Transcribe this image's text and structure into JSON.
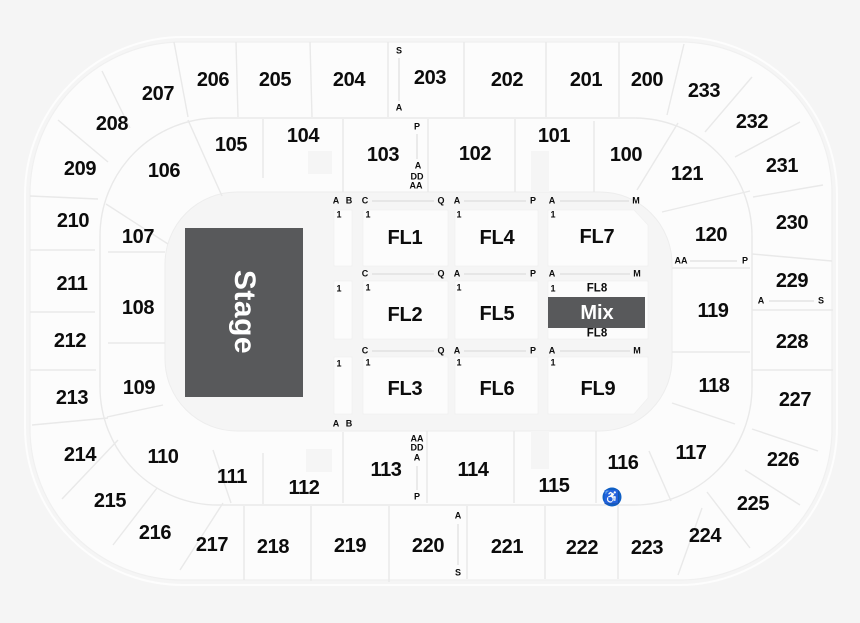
{
  "colors": {
    "background": "#f5f5f5",
    "section_fill": "#fcfcfc",
    "divider": "#e9e9e9",
    "stage_fill": "#58595b",
    "text": "#0c0c0c",
    "accessible_badge": "#0e5fc5",
    "accessible_glyph": "#ffffff"
  },
  "stage": {
    "label": "Stage",
    "x": 244,
    "y": 312
  },
  "mix": {
    "label": "Mix",
    "x": 597,
    "y": 313
  },
  "outer_ring_sections": [
    {
      "label": "200",
      "x": 647,
      "y": 80
    },
    {
      "label": "201",
      "x": 586,
      "y": 80
    },
    {
      "label": "202",
      "x": 507,
      "y": 80
    },
    {
      "label": "203",
      "x": 430,
      "y": 78
    },
    {
      "label": "204",
      "x": 349,
      "y": 80
    },
    {
      "label": "205",
      "x": 275,
      "y": 80
    },
    {
      "label": "206",
      "x": 213,
      "y": 80
    },
    {
      "label": "207",
      "x": 158,
      "y": 94
    },
    {
      "label": "208",
      "x": 112,
      "y": 124
    },
    {
      "label": "209",
      "x": 80,
      "y": 169
    },
    {
      "label": "210",
      "x": 73,
      "y": 221
    },
    {
      "label": "211",
      "x": 72,
      "y": 284
    },
    {
      "label": "212",
      "x": 70,
      "y": 341
    },
    {
      "label": "213",
      "x": 72,
      "y": 398
    },
    {
      "label": "214",
      "x": 80,
      "y": 455
    },
    {
      "label": "215",
      "x": 110,
      "y": 501
    },
    {
      "label": "216",
      "x": 155,
      "y": 533
    },
    {
      "label": "217",
      "x": 212,
      "y": 545
    },
    {
      "label": "218",
      "x": 273,
      "y": 547
    },
    {
      "label": "219",
      "x": 350,
      "y": 546
    },
    {
      "label": "220",
      "x": 428,
      "y": 546
    },
    {
      "label": "221",
      "x": 507,
      "y": 547
    },
    {
      "label": "222",
      "x": 582,
      "y": 548
    },
    {
      "label": "223",
      "x": 647,
      "y": 548
    },
    {
      "label": "224",
      "x": 705,
      "y": 536
    },
    {
      "label": "225",
      "x": 753,
      "y": 504
    },
    {
      "label": "226",
      "x": 783,
      "y": 460
    },
    {
      "label": "227",
      "x": 795,
      "y": 400
    },
    {
      "label": "228",
      "x": 792,
      "y": 342
    },
    {
      "label": "229",
      "x": 792,
      "y": 281
    },
    {
      "label": "230",
      "x": 792,
      "y": 223
    },
    {
      "label": "231",
      "x": 782,
      "y": 166
    },
    {
      "label": "232",
      "x": 752,
      "y": 122
    },
    {
      "label": "233",
      "x": 704,
      "y": 91
    }
  ],
  "inner_ring_sections": [
    {
      "label": "100",
      "x": 626,
      "y": 155
    },
    {
      "label": "101",
      "x": 554,
      "y": 136
    },
    {
      "label": "102",
      "x": 475,
      "y": 154
    },
    {
      "label": "103",
      "x": 383,
      "y": 155
    },
    {
      "label": "104",
      "x": 303,
      "y": 136
    },
    {
      "label": "105",
      "x": 231,
      "y": 145
    },
    {
      "label": "106",
      "x": 164,
      "y": 171
    },
    {
      "label": "107",
      "x": 138,
      "y": 237
    },
    {
      "label": "108",
      "x": 138,
      "y": 308
    },
    {
      "label": "109",
      "x": 139,
      "y": 388
    },
    {
      "label": "110",
      "x": 163,
      "y": 457
    },
    {
      "label": "111",
      "x": 232,
      "y": 477
    },
    {
      "label": "112",
      "x": 304,
      "y": 488
    },
    {
      "label": "113",
      "x": 386,
      "y": 470
    },
    {
      "label": "114",
      "x": 473,
      "y": 470
    },
    {
      "label": "115",
      "x": 554,
      "y": 486
    },
    {
      "label": "116",
      "x": 623,
      "y": 463
    },
    {
      "label": "117",
      "x": 691,
      "y": 453
    },
    {
      "label": "118",
      "x": 714,
      "y": 386
    },
    {
      "label": "119",
      "x": 713,
      "y": 311
    },
    {
      "label": "120",
      "x": 711,
      "y": 235
    },
    {
      "label": "121",
      "x": 687,
      "y": 174
    }
  ],
  "floor_sections": [
    {
      "label": "FL1",
      "x": 405,
      "y": 238
    },
    {
      "label": "FL4",
      "x": 497,
      "y": 238
    },
    {
      "label": "FL7",
      "x": 597,
      "y": 237
    },
    {
      "label": "FL2",
      "x": 405,
      "y": 315
    },
    {
      "label": "FL5",
      "x": 497,
      "y": 314
    },
    {
      "label": "FL3",
      "x": 405,
      "y": 389
    },
    {
      "label": "FL6",
      "x": 497,
      "y": 389
    },
    {
      "label": "FL9",
      "x": 598,
      "y": 389
    }
  ],
  "fl8_markers": [
    {
      "label": "FL8",
      "x": 597,
      "y": 289
    },
    {
      "label": "FL8",
      "x": 597,
      "y": 334
    }
  ],
  "row_letter_markers": [
    {
      "label": "A",
      "x": 336,
      "y": 201
    },
    {
      "label": "B",
      "x": 349,
      "y": 201
    },
    {
      "label": "C",
      "x": 365,
      "y": 201
    },
    {
      "label": "Q",
      "x": 441,
      "y": 201
    },
    {
      "label": "A",
      "x": 457,
      "y": 201
    },
    {
      "label": "P",
      "x": 533,
      "y": 201
    },
    {
      "label": "A",
      "x": 552,
      "y": 201
    },
    {
      "label": "M",
      "x": 636,
      "y": 201
    },
    {
      "label": "C",
      "x": 365,
      "y": 274
    },
    {
      "label": "Q",
      "x": 441,
      "y": 274
    },
    {
      "label": "A",
      "x": 457,
      "y": 274
    },
    {
      "label": "P",
      "x": 533,
      "y": 274
    },
    {
      "label": "A",
      "x": 552,
      "y": 274
    },
    {
      "label": "M",
      "x": 637,
      "y": 274
    },
    {
      "label": "C",
      "x": 365,
      "y": 351
    },
    {
      "label": "Q",
      "x": 441,
      "y": 351
    },
    {
      "label": "A",
      "x": 457,
      "y": 351
    },
    {
      "label": "P",
      "x": 533,
      "y": 351
    },
    {
      "label": "A",
      "x": 552,
      "y": 351
    },
    {
      "label": "M",
      "x": 637,
      "y": 351
    },
    {
      "label": "A",
      "x": 336,
      "y": 424
    },
    {
      "label": "B",
      "x": 349,
      "y": 424
    },
    {
      "label": "S",
      "x": 399,
      "y": 51
    },
    {
      "label": "A",
      "x": 399,
      "y": 108
    },
    {
      "label": "P",
      "x": 417,
      "y": 127
    },
    {
      "label": "A",
      "x": 418,
      "y": 166
    },
    {
      "label": "DD",
      "x": 417,
      "y": 177
    },
    {
      "label": "AA",
      "x": 416,
      "y": 186
    },
    {
      "label": "AA",
      "x": 417,
      "y": 439
    },
    {
      "label": "DD",
      "x": 417,
      "y": 448
    },
    {
      "label": "A",
      "x": 417,
      "y": 458
    },
    {
      "label": "P",
      "x": 417,
      "y": 497
    },
    {
      "label": "A",
      "x": 458,
      "y": 516
    },
    {
      "label": "S",
      "x": 458,
      "y": 573
    },
    {
      "label": "AA",
      "x": 681,
      "y": 261
    },
    {
      "label": "P",
      "x": 745,
      "y": 261
    },
    {
      "label": "A",
      "x": 761,
      "y": 301
    },
    {
      "label": "S",
      "x": 821,
      "y": 301
    }
  ],
  "row_number_markers": [
    {
      "label": "1",
      "x": 339,
      "y": 215
    },
    {
      "label": "1",
      "x": 368,
      "y": 215
    },
    {
      "label": "1",
      "x": 459,
      "y": 215
    },
    {
      "label": "1",
      "x": 553,
      "y": 215
    },
    {
      "label": "1",
      "x": 339,
      "y": 289
    },
    {
      "label": "1",
      "x": 368,
      "y": 288
    },
    {
      "label": "1",
      "x": 459,
      "y": 288
    },
    {
      "label": "1",
      "x": 553,
      "y": 289
    },
    {
      "label": "1",
      "x": 339,
      "y": 364
    },
    {
      "label": "1",
      "x": 368,
      "y": 363
    },
    {
      "label": "1",
      "x": 459,
      "y": 363
    },
    {
      "label": "1",
      "x": 553,
      "y": 363
    }
  ],
  "accessible_icon": {
    "glyph": "♿",
    "x": 612,
    "y": 497,
    "section": "116"
  }
}
